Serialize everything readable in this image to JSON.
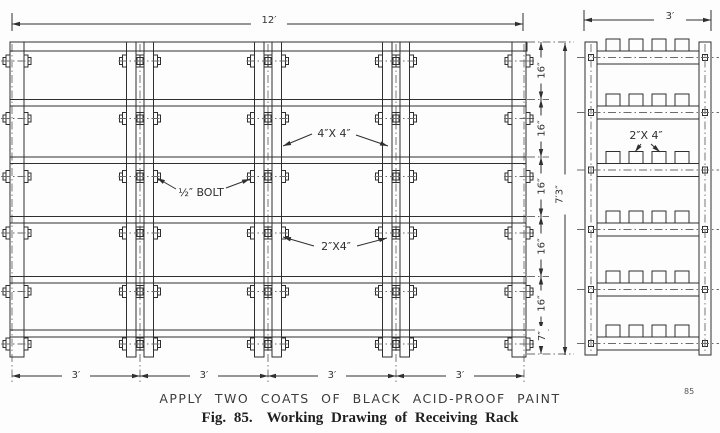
{
  "drawing": {
    "front_view": {
      "overall_width": "12′",
      "overall_height": "7′3″",
      "bay_widths": [
        "3′",
        "3′",
        "3′",
        "3′"
      ],
      "shelf_spacings": [
        "16″",
        "16″",
        "16″",
        "16″",
        "16″"
      ],
      "bottom_offset": "7″",
      "post_label": "4″X 4″",
      "bolt_label": "½″ BOLT",
      "rail_label": "2″X4″"
    },
    "side_view": {
      "overall_depth": "3′",
      "slat_label": "2″X 4″"
    },
    "note": "APPLY TWO COATS OF BLACK ACID-PROOF PAINT",
    "caption": {
      "figure": "Fig. 85.",
      "title": "Working Drawing of Receiving Rack"
    },
    "page_number": "85"
  }
}
